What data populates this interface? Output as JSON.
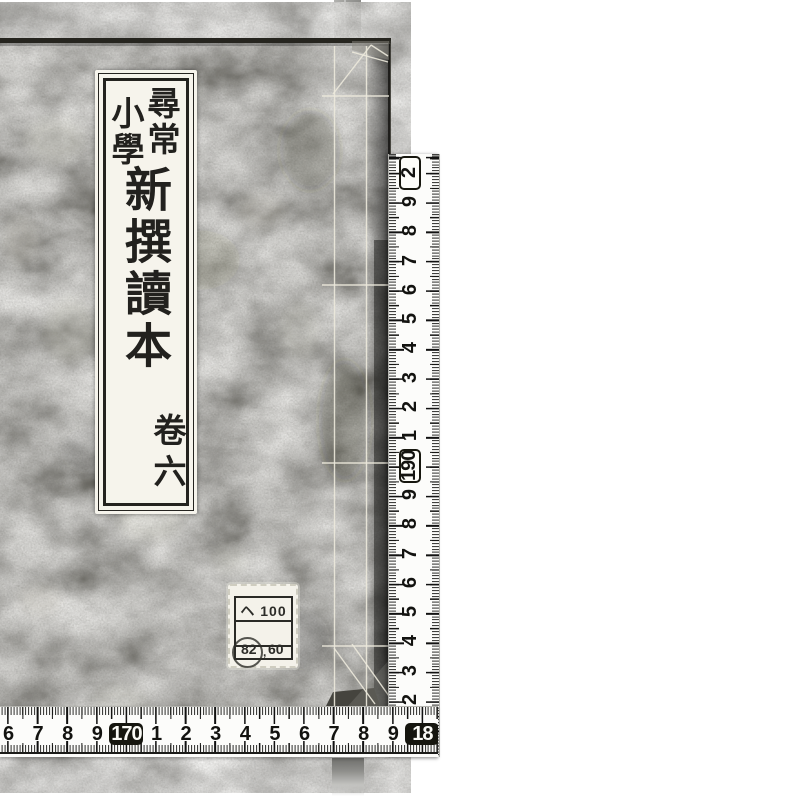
{
  "scene": {
    "type": "photograph",
    "description": "Scanned photograph of a Japanese stab-bound book cover with measuring tapes along its right and bottom edges",
    "background_color": "#ffffff"
  },
  "book": {
    "title_slip": {
      "header_right": "尋常",
      "header_left": "小學",
      "main_title": "新撰讀本",
      "volume": "卷六"
    },
    "label": {
      "line1": "ヘ 100",
      "line2": "",
      "number_left": "82",
      "number_separator": ",",
      "number_right": "60"
    },
    "cover_color": "#6b695f",
    "edge_shadow_color": "#1f1e1b",
    "thread_color": "#e9e6da"
  },
  "rulers": {
    "unit": "mm",
    "tick_color": "#1a1a18",
    "background": "#fcfcfa",
    "horizontal": {
      "labels": [
        {
          "text": "6"
        },
        {
          "text": "7"
        },
        {
          "text": "8"
        },
        {
          "text": "9"
        },
        {
          "text": "170",
          "style": "filled"
        },
        {
          "text": "1"
        },
        {
          "text": "2"
        },
        {
          "text": "3"
        },
        {
          "text": "4"
        },
        {
          "text": "5"
        },
        {
          "text": "6"
        },
        {
          "text": "7"
        },
        {
          "text": "8"
        },
        {
          "text": "9"
        },
        {
          "text": "18",
          "style": "filled"
        }
      ]
    },
    "vertical": {
      "labels": [
        {
          "text": "2"
        },
        {
          "text": "3"
        },
        {
          "text": "4"
        },
        {
          "text": "5"
        },
        {
          "text": "6"
        },
        {
          "text": "7"
        },
        {
          "text": "8"
        },
        {
          "text": "9"
        },
        {
          "text": "190",
          "style": "boxed"
        },
        {
          "text": "1"
        },
        {
          "text": "2"
        },
        {
          "text": "3"
        },
        {
          "text": "4"
        },
        {
          "text": "5"
        },
        {
          "text": "6"
        },
        {
          "text": "7"
        },
        {
          "text": "8"
        },
        {
          "text": "9"
        },
        {
          "text": "2",
          "style": "boxed"
        }
      ]
    }
  }
}
